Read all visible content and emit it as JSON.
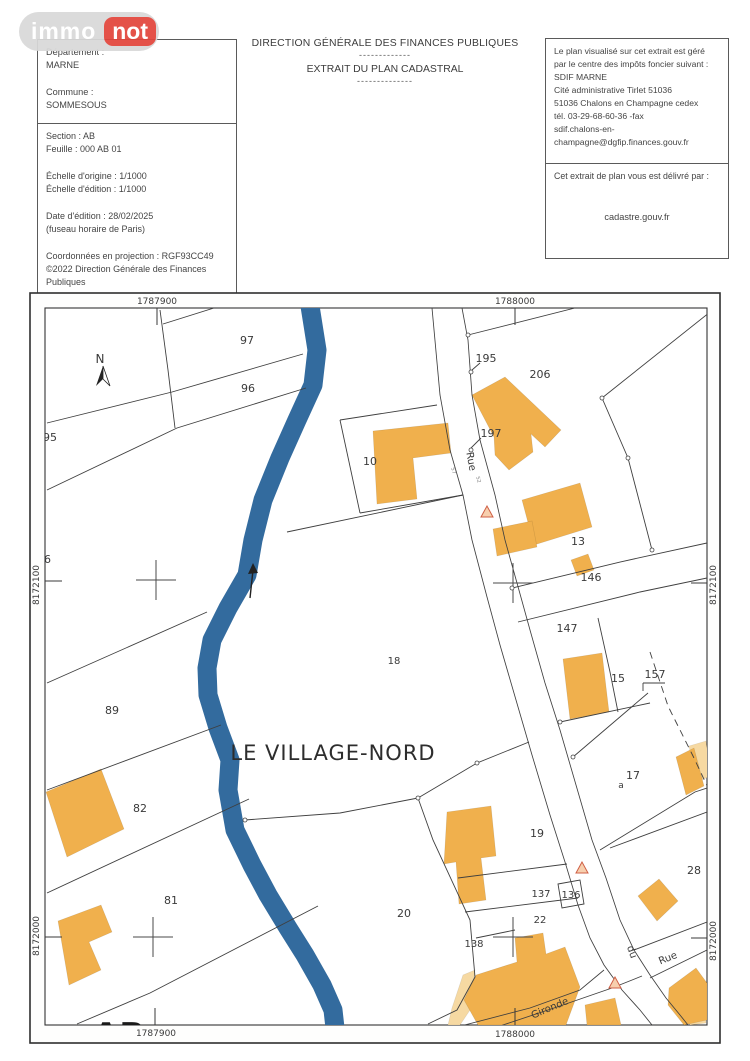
{
  "logo": {
    "immo": "immo",
    "not": "not"
  },
  "header": {
    "region_box": {
      "lines": [
        "Département :",
        "MARNE",
        "",
        "Commune :",
        "SOMMESOUS"
      ]
    },
    "info_box": {
      "lines": [
        "Section : AB",
        "Feuille : 000 AB 01",
        "",
        "Échelle d'origine : 1/1000",
        "Échelle d'édition : 1/1000",
        "",
        "Date d'édition : 28/02/2025",
        "(fuseau horaire de Paris)",
        "",
        "Coordonnées en projection : RGF93CC49",
        "©2022 Direction Générale des Finances",
        "Publiques"
      ]
    },
    "title": {
      "line1": "DIRECTION GÉNÉRALE DES FINANCES PUBLIQUES",
      "sep1": "-------------",
      "line2": "EXTRAIT DU PLAN CADASTRAL",
      "sep2": "--------------"
    },
    "office_box": {
      "lines": [
        "Le plan visualisé sur cet extrait est géré",
        "par le centre des impôts foncier suivant :",
        "SDIF MARNE",
        "Cité administrative Tirlet  51036",
        "51036 Chalons en Champagne cedex",
        "tél. 03-29-68-60-36 -fax",
        "sdif.chalons-en-",
        "champagne@dgfip.finances.gouv.fr"
      ]
    },
    "delivery_box": {
      "label": "Cet extrait de plan vous est délivré par :",
      "provider": "cadastre.gouv.fr"
    }
  },
  "map": {
    "colors": {
      "building": "#f0b04d",
      "building_light": "#f6d9a2",
      "water": "#336b9e",
      "line": "#3f3f3f",
      "accent": "#e2453c"
    },
    "labels": [
      {
        "t": "1787900",
        "x": 157,
        "y": 304,
        "s": 9,
        "g": "frame",
        "n": "coord-top-1787900"
      },
      {
        "t": "1788000",
        "x": 515,
        "y": 304,
        "s": 9,
        "g": "frame",
        "n": "coord-top-1788000"
      },
      {
        "t": "1787900",
        "x": 156,
        "y": 1036,
        "s": 9,
        "g": "frame",
        "n": "coord-bottom-1787900"
      },
      {
        "t": "1788000",
        "x": 515,
        "y": 1037,
        "s": 9,
        "g": "frame",
        "n": "coord-bottom-1788000"
      },
      {
        "t": "8172100",
        "x": 39,
        "y": 585,
        "s": 9,
        "r": -90,
        "g": "frame",
        "n": "coord-left-8172100"
      },
      {
        "t": "8172000",
        "x": 39,
        "y": 936,
        "s": 9,
        "r": -90,
        "g": "frame",
        "n": "coord-left-8172000"
      },
      {
        "t": "8172100",
        "x": 716,
        "y": 585,
        "s": 9,
        "r": -90,
        "g": "frame",
        "n": "coord-right-8172100"
      },
      {
        "t": "8172000",
        "x": 716,
        "y": 941,
        "s": 9,
        "r": -90,
        "g": "frame",
        "n": "coord-right-8172000"
      },
      {
        "t": "N",
        "x": 100,
        "y": 363,
        "s": 12,
        "n": "north-label"
      },
      {
        "t": "97",
        "x": 247,
        "y": 344,
        "n": "parcel-label-97"
      },
      {
        "t": "96",
        "x": 248,
        "y": 392,
        "n": "parcel-label-96"
      },
      {
        "t": "95",
        "x": 50,
        "y": 441,
        "n": "parcel-label-95"
      },
      {
        "t": "86",
        "x": 44,
        "y": 563,
        "n": "parcel-label-86"
      },
      {
        "t": "10",
        "x": 370,
        "y": 465,
        "n": "parcel-label-10"
      },
      {
        "t": "195",
        "x": 486,
        "y": 362,
        "n": "parcel-label-195"
      },
      {
        "t": "206",
        "x": 540,
        "y": 378,
        "n": "parcel-label-206"
      },
      {
        "t": "197",
        "x": 491,
        "y": 437,
        "n": "parcel-label-197"
      },
      {
        "t": "13",
        "x": 578,
        "y": 545,
        "n": "parcel-label-13"
      },
      {
        "t": "146",
        "x": 591,
        "y": 581,
        "n": "parcel-label-146"
      },
      {
        "t": "147",
        "x": 567,
        "y": 632,
        "n": "parcel-label-147"
      },
      {
        "t": "15",
        "x": 618,
        "y": 682,
        "n": "parcel-label-15"
      },
      {
        "t": "157",
        "x": 655,
        "y": 678,
        "n": "parcel-label-157"
      },
      {
        "t": "17",
        "x": 633,
        "y": 779,
        "n": "parcel-label-17"
      },
      {
        "t": "a",
        "x": 621,
        "y": 788,
        "s": 9,
        "n": "parcel-label-17a"
      },
      {
        "t": "89",
        "x": 112,
        "y": 714,
        "n": "parcel-label-89"
      },
      {
        "t": "18",
        "x": 394,
        "y": 664,
        "s": 10,
        "n": "parcel-label-18"
      },
      {
        "t": "82",
        "x": 140,
        "y": 812,
        "n": "parcel-label-82"
      },
      {
        "t": "81",
        "x": 171,
        "y": 904,
        "n": "parcel-label-81"
      },
      {
        "t": "19",
        "x": 537,
        "y": 837,
        "n": "parcel-label-19"
      },
      {
        "t": "20",
        "x": 404,
        "y": 917,
        "n": "parcel-label-20"
      },
      {
        "t": "137",
        "x": 541,
        "y": 897,
        "s": 10,
        "n": "parcel-label-137"
      },
      {
        "t": "136",
        "x": 571,
        "y": 898,
        "s": 10,
        "n": "parcel-label-136"
      },
      {
        "t": "22",
        "x": 540,
        "y": 923,
        "s": 10,
        "n": "parcel-label-22"
      },
      {
        "t": "138",
        "x": 474,
        "y": 947,
        "s": 10,
        "n": "parcel-label-138"
      },
      {
        "t": "28",
        "x": 694,
        "y": 874,
        "n": "parcel-label-28"
      },
      {
        "t": "LE VILLAGE-NORD",
        "x": 333,
        "y": 760,
        "s": 21,
        "ls": 1,
        "c": "#2d2d2d",
        "n": "place-name"
      },
      {
        "t": "Rue",
        "x": 468,
        "y": 462,
        "s": 10,
        "r": 80,
        "n": "street-label-rue-north"
      },
      {
        "t": "Rue",
        "x": 669,
        "y": 961,
        "s": 10,
        "r": -22,
        "n": "street-label-rue-southeast"
      },
      {
        "t": "du",
        "x": 629,
        "y": 953,
        "s": 10,
        "r": 70,
        "n": "street-label-du"
      },
      {
        "t": "Gironde",
        "x": 551,
        "y": 1011,
        "s": 10,
        "r": -23,
        "n": "street-label-gironde"
      },
      {
        "t": "57",
        "x": 452,
        "y": 471,
        "s": 5,
        "r": 75,
        "c": "#808080",
        "n": "road-tiny-mark-57"
      },
      {
        "t": "52",
        "x": 477,
        "y": 480,
        "s": 5,
        "r": 75,
        "c": "#808080",
        "n": "road-tiny-mark-52"
      },
      {
        "t": "AB",
        "x": 119,
        "y": 1047,
        "s": 34,
        "w": "bold",
        "c": "#1a1a1a",
        "n": "section-label-ab"
      }
    ]
  }
}
